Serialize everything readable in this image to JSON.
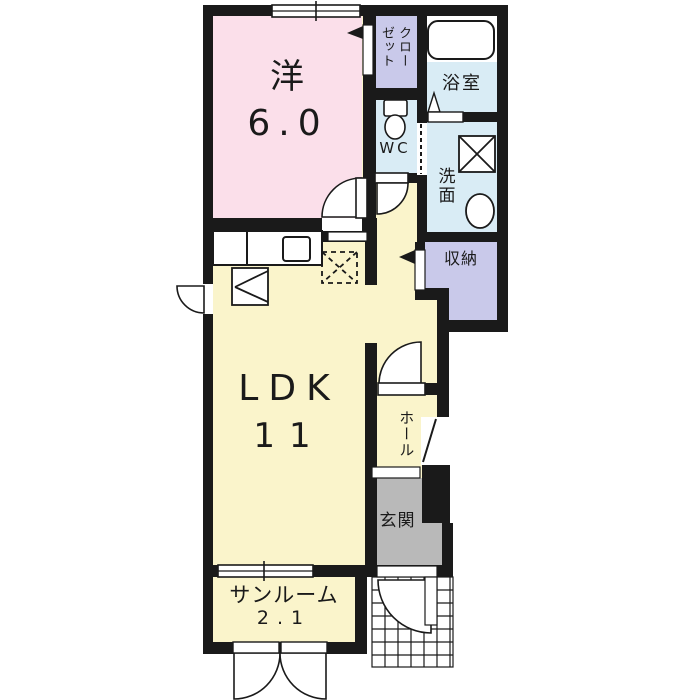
{
  "floorplan": {
    "rooms": {
      "western_room": {
        "name": "洋",
        "size": "6.0"
      },
      "ldk": {
        "name": "LDK",
        "size": "11"
      },
      "sunroom": {
        "name": "サンルーム",
        "size": "2.1"
      },
      "closet": {
        "name": "クローゼット"
      },
      "wc": {
        "name": "WC"
      },
      "bathroom": {
        "name": "浴室"
      },
      "washroom": {
        "name": "洗面"
      },
      "storage": {
        "name": "収納"
      },
      "hall": {
        "name": "ホール"
      },
      "entrance": {
        "name": "玄関"
      }
    },
    "colors": {
      "western_room": "#fbdfea",
      "ldk_floor": "#faf4cb",
      "wet_area": "#d9ecf5",
      "closet_storage": "#c9c9ea",
      "entrance_floor": "#b9b9b9",
      "wall": "#1a1a1a",
      "background": "#ffffff"
    },
    "fixtures": [
      "bathtub-icon",
      "toilet-icon",
      "washbasin-icon",
      "washing-machine-pan-icon",
      "kitchen-counter",
      "kitchen-sink-icon",
      "stove-icon",
      "refrigerator-space",
      "entrance-tile-grid",
      "door-swing-arcs",
      "sliding-windows"
    ]
  }
}
